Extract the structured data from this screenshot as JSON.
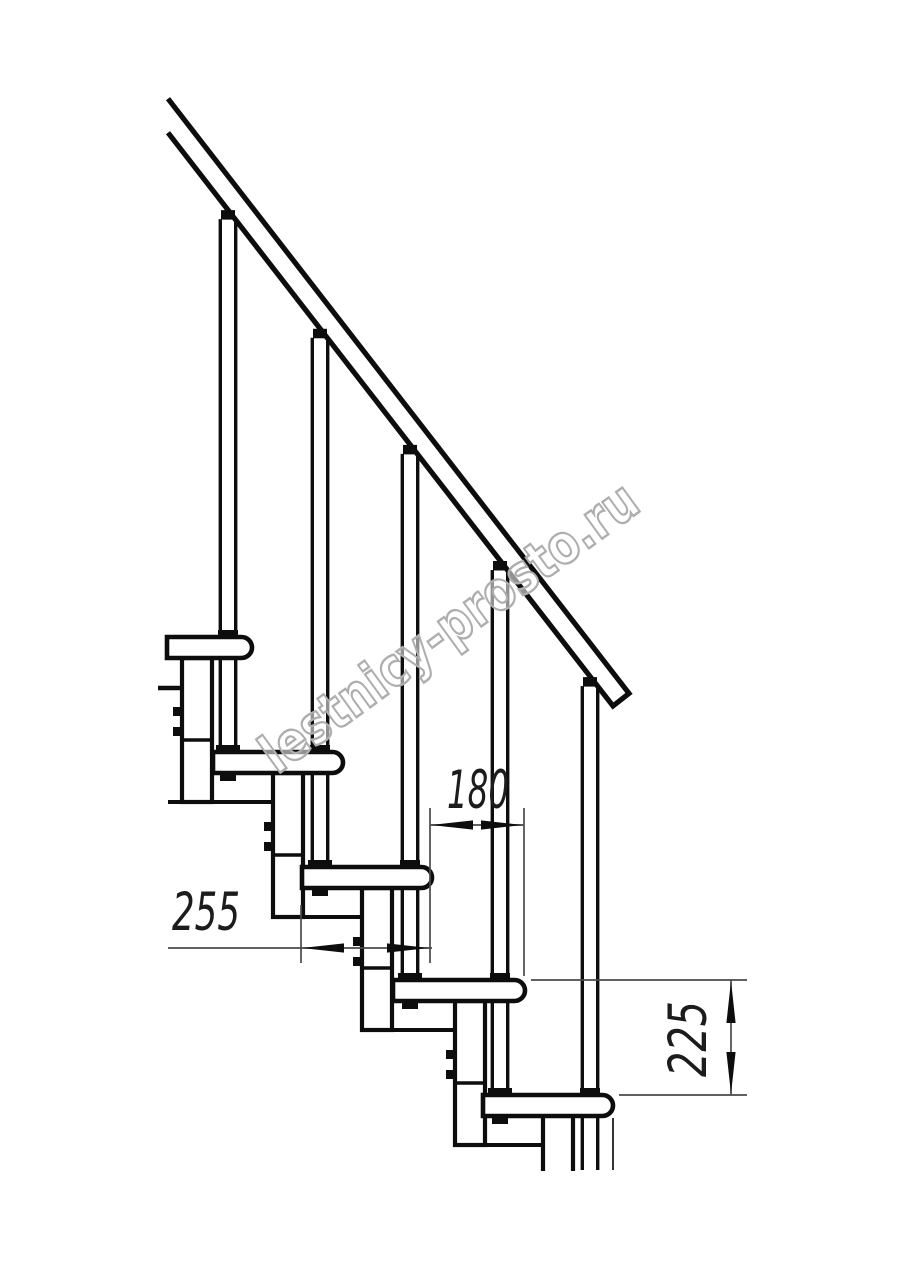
{
  "title": "Modular staircase side-view technical drawing",
  "watermark": {
    "text": "lestnicy-prosto.ru",
    "color": "#aeaeae"
  },
  "dimensions": {
    "tread_depth_mm": "255",
    "step_offset_mm": "180",
    "rise_mm": "225"
  },
  "colors": {
    "background": "#ffffff",
    "line": "#0d0d0d",
    "thin_line": "#4a4a4a",
    "dim_text": "#1c1c1c"
  },
  "drawing": {
    "canvas": {
      "width": 914,
      "height": 1280
    },
    "rail": {
      "x_start": 168,
      "x_end": 629,
      "slope": 1.29,
      "top_intercept": -118,
      "bottom_intercept": -84,
      "end_face_x": 613,
      "end_face_y": 706,
      "stroke": 5.2
    },
    "steps": [
      {
        "top": 637,
        "left": 167,
        "right": 252,
        "height": 21
      },
      {
        "top": 752,
        "left": 213,
        "right": 343,
        "height": 21
      },
      {
        "top": 867,
        "left": 302,
        "right": 432,
        "height": 21
      },
      {
        "top": 980,
        "left": 393,
        "right": 525,
        "height": 21
      },
      {
        "top": 1095,
        "left": 483,
        "right": 613,
        "height": 21
      }
    ],
    "balusters": [
      228,
      320,
      410,
      500,
      590
    ],
    "baluster_cut_bottom": 1170,
    "module": {
      "offset_from_right": 70,
      "width": 30,
      "depth_below_next_top": 50,
      "divider_above_next_top": 12
    },
    "left_tab": {
      "x1": 158,
      "x2": 182,
      "y": 688
    },
    "edge_stub": {
      "x": 613,
      "y1": 1118,
      "y2": 1170
    },
    "dims": {
      "d255": {
        "line_y": 948,
        "x1": 168,
        "x2": 432,
        "tip_left": 302,
        "tip_right": 429,
        "ext": [
          {
            "x": 301,
            "y1": 905,
            "y2": 963
          }
        ]
      },
      "d180": {
        "line_y": 825,
        "x1": 430,
        "x2": 524,
        "tip_left": 431,
        "tip_right": 523,
        "ext": [
          {
            "x": 430,
            "y1": 808,
            "y2": 963
          },
          {
            "x": 524,
            "y1": 808,
            "y2": 976
          }
        ]
      },
      "d225": {
        "line_x": 731,
        "y1": 980,
        "y2": 1095,
        "ext_top": {
          "y": 980,
          "x1": 531,
          "x2": 747
        },
        "ext_bottom": {
          "y": 1095,
          "x1": 619,
          "x2": 747
        }
      }
    }
  }
}
